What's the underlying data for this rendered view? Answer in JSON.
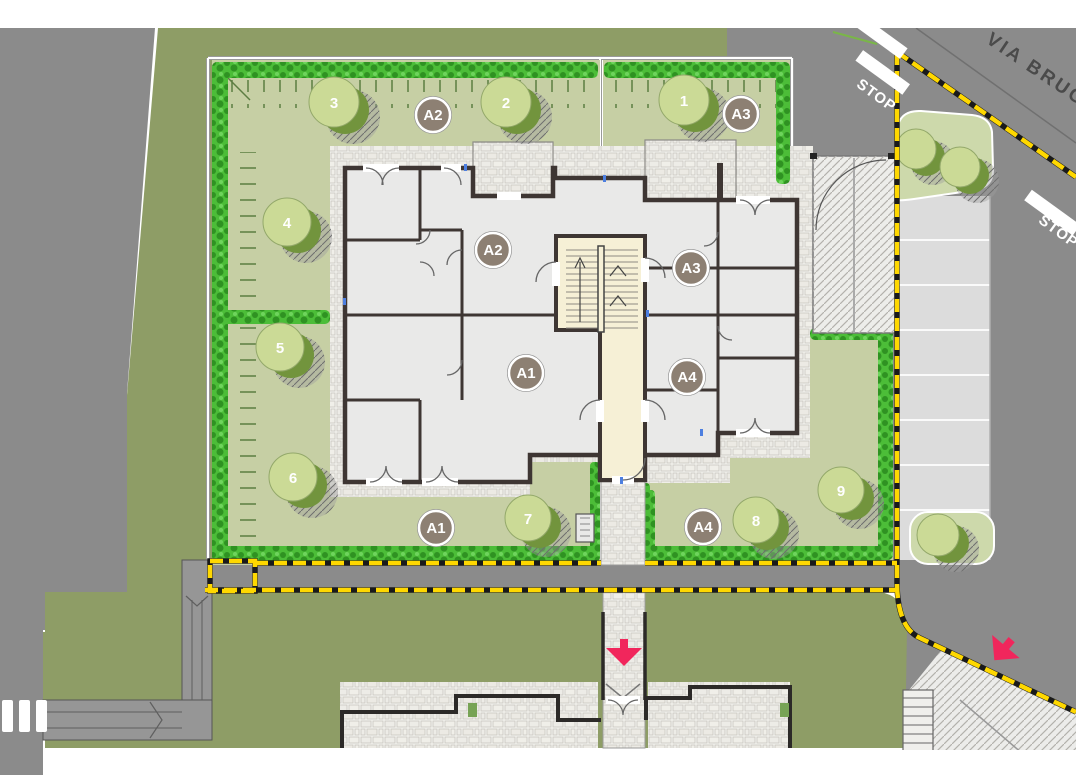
{
  "plan": {
    "street_name": "VIA BRUGH",
    "stop_left": "STOP",
    "stop_right": "STOP",
    "interior_labels": [
      "A2",
      "A3",
      "A1",
      "A4"
    ],
    "garden_labels": [
      "A2",
      "A3",
      "A1",
      "A4"
    ],
    "tree_numbers": [
      "1",
      "2",
      "3",
      "4",
      "5",
      "6",
      "7",
      "8",
      "9"
    ],
    "colors": {
      "boundary_yellow": "#ffd800",
      "arrow_red": "#f1265c",
      "hedge_green": "#4cbd38",
      "lawn_olive": "#8e9d66",
      "garden_green": "#c6cfa4",
      "canopy_light": "#cbda96",
      "canopy_dark": "#72943d",
      "road_gray": "#8b8b8b",
      "parking_gray": "#dcdcdc",
      "stair_cream": "#f6f0d6",
      "wall_dark": "#3e3633",
      "label_brown": "#8d8073"
    }
  }
}
